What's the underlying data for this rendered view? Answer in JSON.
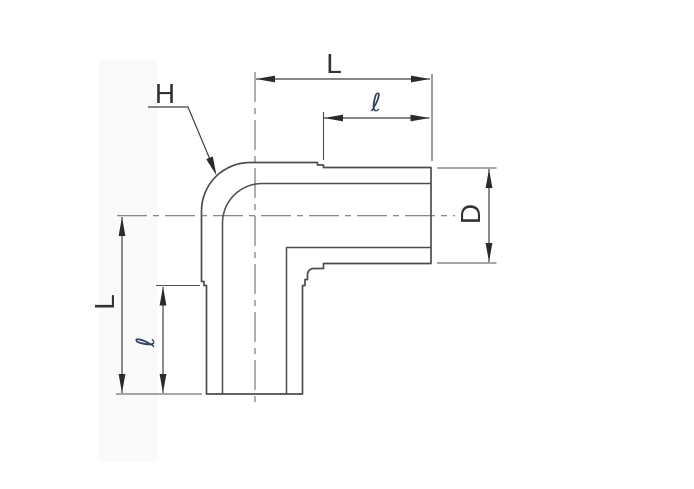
{
  "labels": {
    "length_top": "L",
    "tangent_top": "ℓ",
    "radius_leader": "H",
    "diameter_right": "D",
    "length_left": "L",
    "tangent_left": "ℓ"
  },
  "colors": {
    "background": "#ffffff",
    "object_line": "#4d4d4d",
    "dimension_line": "#3f3f3f",
    "centerline": "#787878",
    "arrowhead": "#2b2b2b",
    "text": "#333333"
  }
}
